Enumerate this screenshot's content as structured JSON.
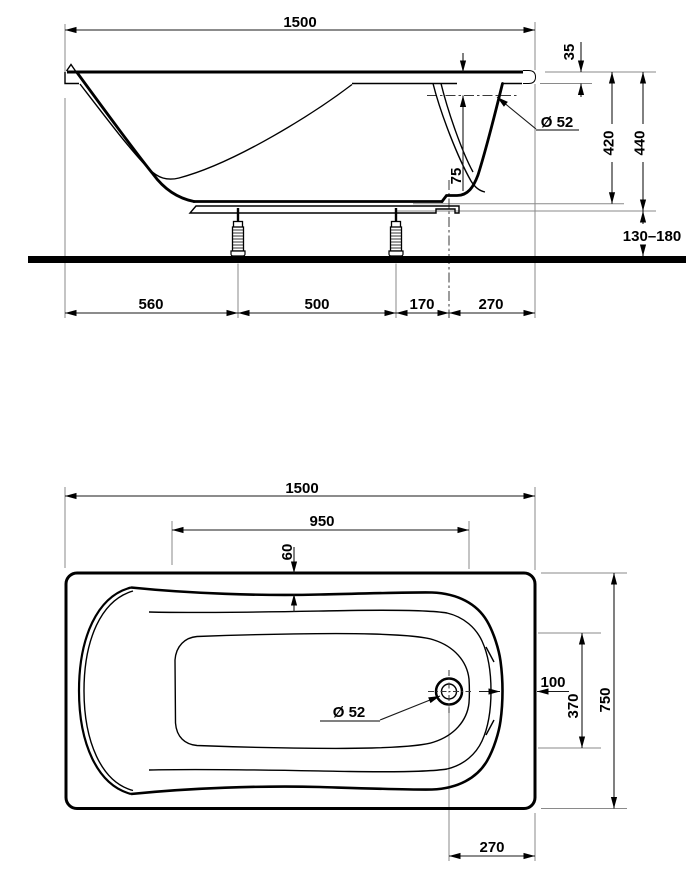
{
  "side_view": {
    "dims": {
      "overall_length": "1500",
      "rim_height": "35",
      "overflow_below_rim": "75",
      "overflow_diameter": "Ø 52",
      "inner_depth": "420",
      "body_height": "440",
      "foot_height_range": "130–180",
      "seg_left": "560",
      "seg_feet": "500",
      "seg_foot_drain": "170",
      "seg_drain_end": "270"
    }
  },
  "top_view": {
    "dims": {
      "overall_length": "1500",
      "bottom_length": "950",
      "rim_flat_width": "60",
      "bowl_to_edge": "100",
      "drain_diameter": "Ø 52",
      "bottom_width_at_drain": "370",
      "overall_width": "750",
      "drain_offset_from_end": "270"
    }
  }
}
